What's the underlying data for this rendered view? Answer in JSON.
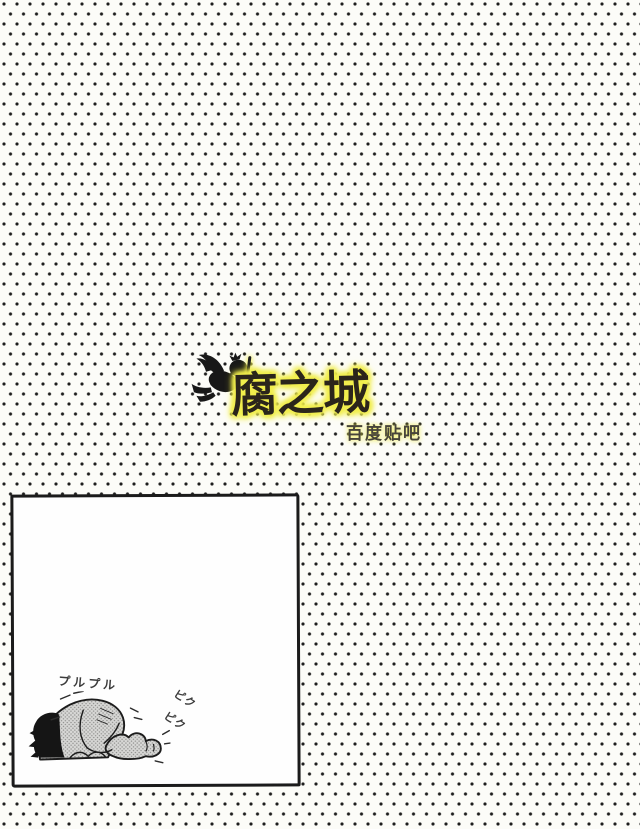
{
  "page": {
    "paper_color": "#fcfcf8",
    "dot_color": "#1e1e1e"
  },
  "logo": {
    "title": "腐之城",
    "subtitle": "百度贴吧",
    "highlight_color": "#f1ee4d",
    "title_color": "#2b251b",
    "subtitle_color": "#47443a",
    "cherub_icon": "flying-cherub-silhouette"
  },
  "panel": {
    "illustration": "person-kneeling-curled-up-trembling",
    "sfx": {
      "trembling": "プルプル",
      "twitch_1": "ピク",
      "twitch_2": "ピク"
    }
  }
}
